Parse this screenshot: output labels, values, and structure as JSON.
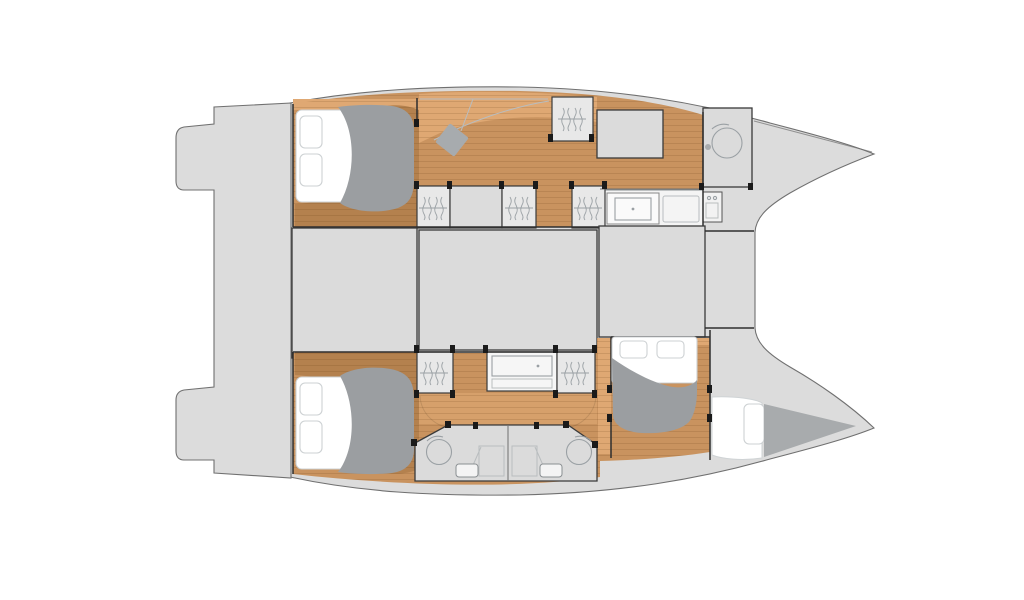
{
  "meta": {
    "description": "Catamaran yacht interior layout floor plan, top-down naval architecture drawing, no text labels",
    "diagram_type": "boat-floor-plan"
  },
  "colors": {
    "background": "#ffffff",
    "deck": "#dcdcdc",
    "deck_line": "#707070",
    "room": "#dbdbdb",
    "wall": "#2e2e2e",
    "wood": "#c9935f",
    "wood_light": "#dfa873",
    "wood_dark": "#b4814e",
    "duvet": "#9b9ea1",
    "mattress": "#ffffff",
    "soft_line": "#cdd1d3",
    "furniture_line": "#9aa0a4",
    "fixture_fill": "#f4f4f4",
    "shadow_gray": "#a8abad",
    "post": "#1a1a1a"
  },
  "rooms": [
    "aft-swim-platform",
    "port-hull-aft-cabin",
    "port-hull-corridor-desk",
    "port-hull-forward-berth",
    "port-bow-bathroom",
    "saloon-bridgedeck",
    "foredeck",
    "starboard-hull-aft-cabin",
    "starboard-hull-corridor",
    "starboard-twin-shower-rooms",
    "starboard-mid-cabin",
    "starboard-bow-berth"
  ],
  "fixtures": [
    {
      "name": "double-bed",
      "count": 3
    },
    {
      "name": "single-berth",
      "count": 2
    },
    {
      "name": "wardrobe-hanging-locker",
      "count": 6
    },
    {
      "name": "shower-stall",
      "count": 3
    },
    {
      "name": "toilet",
      "count": 2
    },
    {
      "name": "washbasin-counter",
      "count": 2
    },
    {
      "name": "desk-with-stool",
      "count": 1
    }
  ]
}
